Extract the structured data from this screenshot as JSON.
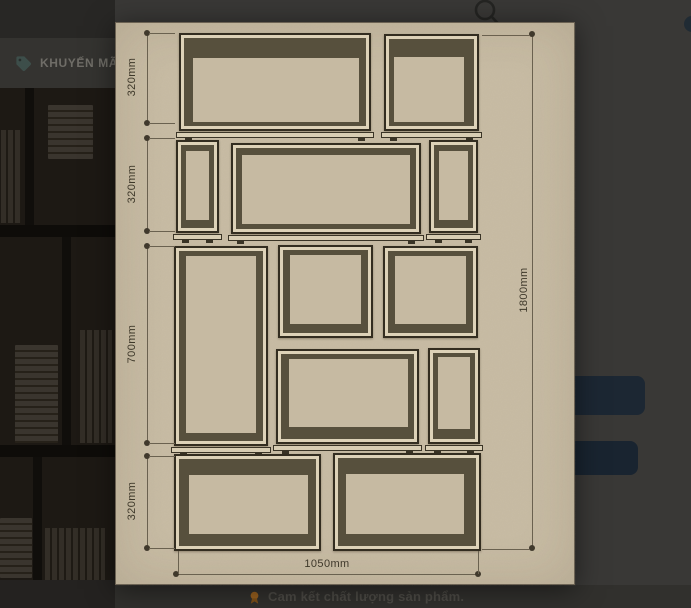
{
  "page": {
    "promo": {
      "label": "KHUYẾN MÃI"
    },
    "footer_note": "Cam kết chất lượng sản phẩm.",
    "icons": [
      "tag-icon",
      "search-icon",
      "quality-badge-icon"
    ],
    "colors": {
      "backdrop": "#393836",
      "promo_strip": "#343330",
      "action_button_primary": "#1c2733",
      "action_button_secondary": "#192430"
    }
  },
  "lightbox": {
    "paper_color": "#c9bda5",
    "diagram": {
      "title": "shelf-dimension-sketch",
      "left_dims": [
        {
          "label": "320mm",
          "y1": 10,
          "y2": 100
        },
        {
          "label": "320mm",
          "y1": 115,
          "y2": 208
        },
        {
          "label": "700mm",
          "y1": 223,
          "y2": 420
        },
        {
          "label": "320mm",
          "y1": 433,
          "y2": 525
        }
      ],
      "right_dim": {
        "label": "1800mm",
        "x": 416,
        "y1": 11,
        "y2": 525
      },
      "bottom_dim": {
        "label": "1050mm",
        "y": 551,
        "x1": 60,
        "x2": 362
      },
      "boxes": [
        {
          "x": 63,
          "y": 10,
          "w": 192,
          "h": 98,
          "bw": "20px 7px 4px 9px",
          "sill": true
        },
        {
          "x": 268,
          "y": 11,
          "w": 95,
          "h": 97,
          "bw": "18px 10px 4px 5px",
          "sill": true
        },
        {
          "x": 60,
          "y": 117,
          "w": 43,
          "h": 93,
          "bw": "6px 5px 8px 5px",
          "sill": true
        },
        {
          "x": 115,
          "y": 120,
          "w": 190,
          "h": 91,
          "bw": "7px 6px 5px 6px",
          "sill": true
        },
        {
          "x": 313,
          "y": 117,
          "w": 49,
          "h": 93,
          "bw": "6px 5px 8px 5px",
          "sill": true
        },
        {
          "x": 58,
          "y": 223,
          "w": 94,
          "h": 200,
          "bw": "5px 7px 8px 7px",
          "sill": true
        },
        {
          "x": 162,
          "y": 222,
          "w": 95,
          "h": 93,
          "bw": "5px 7px 9px 7px",
          "sill": false
        },
        {
          "x": 267,
          "y": 223,
          "w": 95,
          "h": 92,
          "bw": "5px 7px 9px 7px",
          "sill": false
        },
        {
          "x": 160,
          "y": 326,
          "w": 143,
          "h": 95,
          "bw": "5px 6px 12px 8px",
          "sill": true
        },
        {
          "x": 312,
          "y": 325,
          "w": 52,
          "h": 96,
          "bw": "4px 5px 10px 5px",
          "sill": true
        },
        {
          "x": 58,
          "y": 431,
          "w": 147,
          "h": 97,
          "bw": "16px 8px 12px 10px",
          "sill": false
        },
        {
          "x": 217,
          "y": 430,
          "w": 148,
          "h": 98,
          "bw": "16px 12px 12px 8px",
          "sill": false
        }
      ]
    }
  }
}
